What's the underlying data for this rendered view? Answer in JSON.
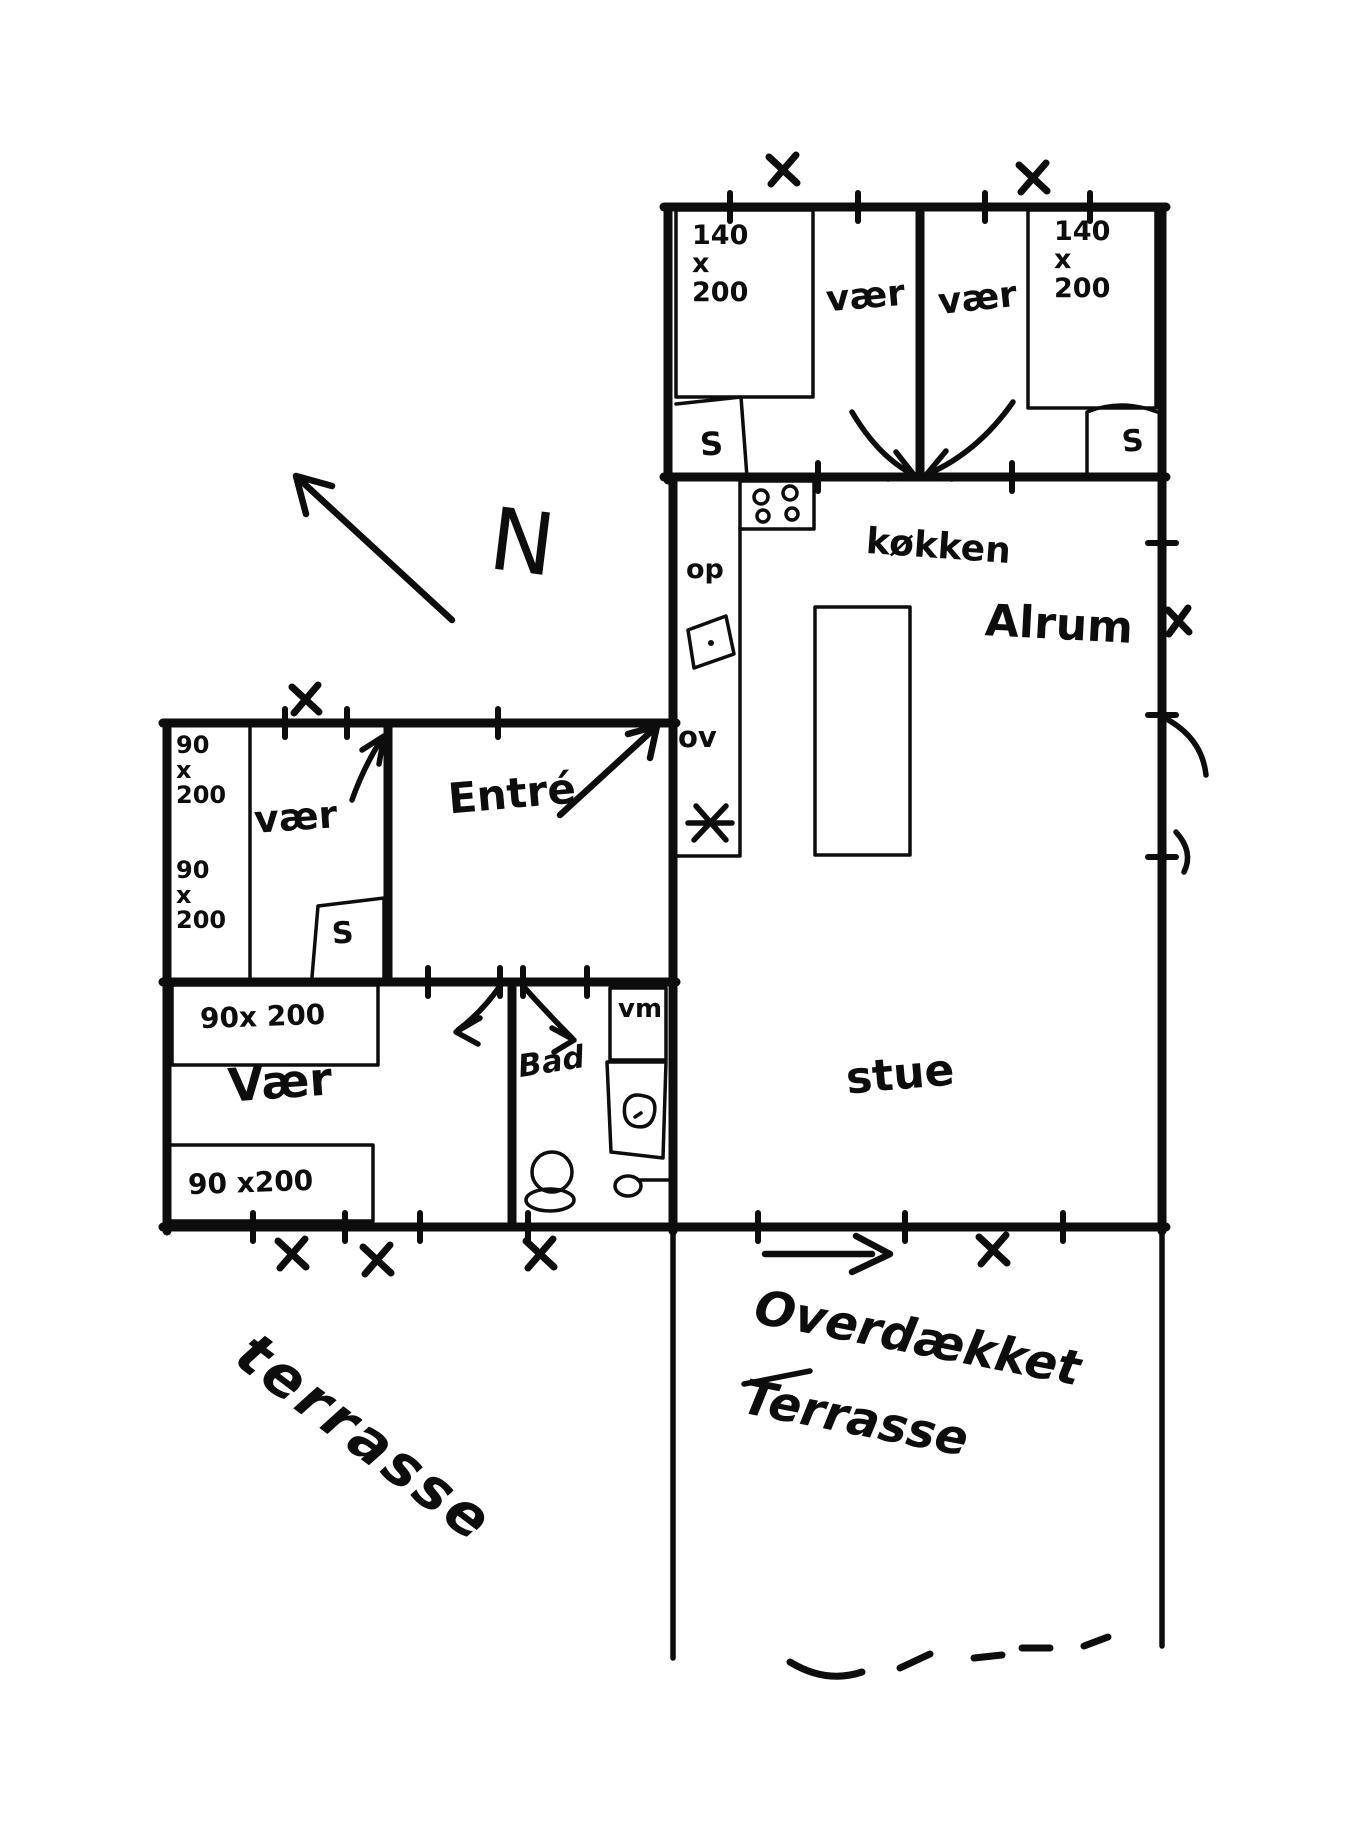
{
  "compass": {
    "label": "N"
  },
  "bedroom_nw": {
    "label": "vær",
    "bed_size": "140\nx\n200",
    "wardrobe": "S"
  },
  "bedroom_ne": {
    "label": "vær",
    "bed_size": "140\nx\n200",
    "wardrobe": "S"
  },
  "kitchen": {
    "label": "køkken",
    "counter_label_top": "op",
    "counter_label_bottom": "ov"
  },
  "alrum": {
    "label": "Alrum"
  },
  "livingroom": {
    "label": "stue"
  },
  "entre": {
    "label": "Entré"
  },
  "bedroom_w": {
    "label": "vær",
    "bed_size_top": "90\nx\n200",
    "bed_size_bottom": "90\nx\n200",
    "wardrobe": "S"
  },
  "bedroom_sw": {
    "label": "Vær",
    "bed_top": "90x 200",
    "bed_bottom": "90 x200"
  },
  "bathroom": {
    "label": "Bad",
    "washing_machine": "vm"
  },
  "terrace_covered": {
    "line1": "Overdækket",
    "line2": "Terrasse"
  },
  "terrace_open": {
    "label": "terrasse"
  },
  "ink_color": "#0d0d0d"
}
